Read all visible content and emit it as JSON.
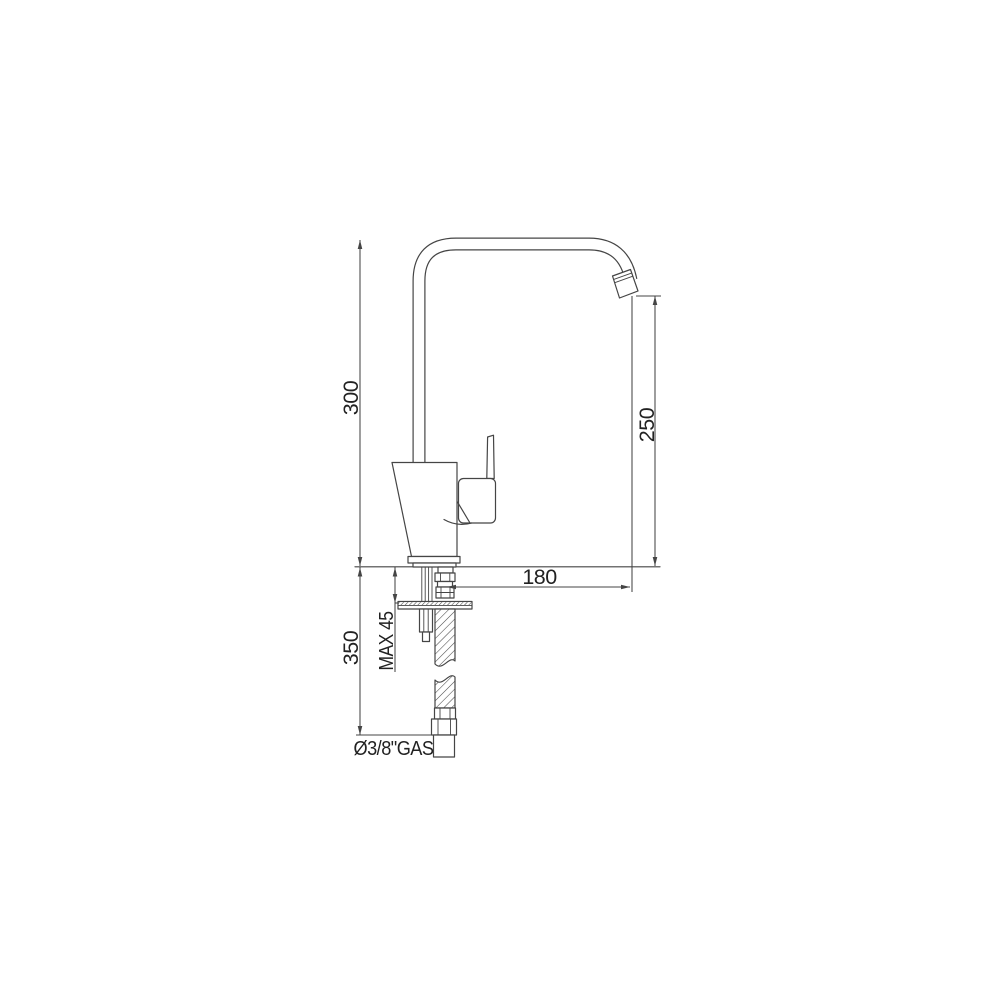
{
  "page": {
    "background": "#ffffff",
    "line_color": "#454545",
    "text_color": "#222222"
  },
  "drawing": {
    "type": "technical-dimension-drawing",
    "subject": "single-lever kitchen mixer tap, side elevation with installation dimensions",
    "units": "mm",
    "labels": {
      "overall_height": "300",
      "spout_outlet_height": "250",
      "spout_reach": "180",
      "max_mounting_thickness": "MAX 45",
      "below_deck_length": "350",
      "supply_connection": "Ø3/8\"GAS"
    }
  }
}
